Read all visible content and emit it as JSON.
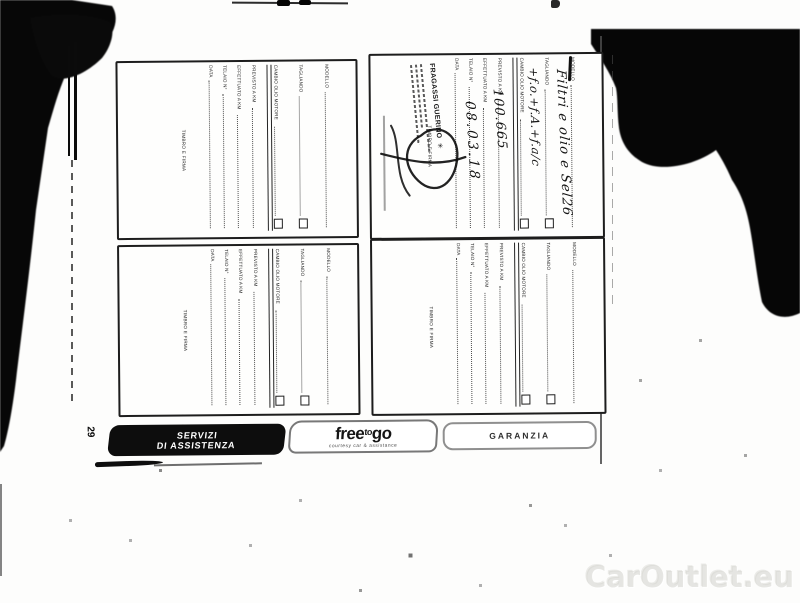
{
  "page": {
    "number": "29",
    "watermark": "CarOutlet.eu"
  },
  "coupon_labels": {
    "modello": "MODELLO",
    "tagliando": "TAGLIANDO",
    "cambio_olio": "CAMBIO OLIO MOTORE",
    "previsto": "PREVISTO A KM",
    "effettuato": "EFFETTUATO A KM",
    "telaio": "TELAIO N°",
    "data": "DATA",
    "timbro": "TIMBRO E FIRMA"
  },
  "filled_coupon": {
    "tagliando_note": "Filtri e olio e Sel26",
    "cambio_olio_note": "+f.o.+f.A.+f.a/c",
    "effettuato_km": "100.665",
    "data_value": "08.03.18",
    "stamp_name": "FRAGASSI GUERINO",
    "stamp_logo_glyph": "✳"
  },
  "tabs": {
    "servizi": {
      "line1": "SERVIZI",
      "line2": "DI ASSISTENZA"
    },
    "freetogo": {
      "part1": "free",
      "part2": "to",
      "part3": "go",
      "sub": "courtesy car & assistance"
    },
    "garanzia": {
      "label": "GARANZIA"
    }
  }
}
